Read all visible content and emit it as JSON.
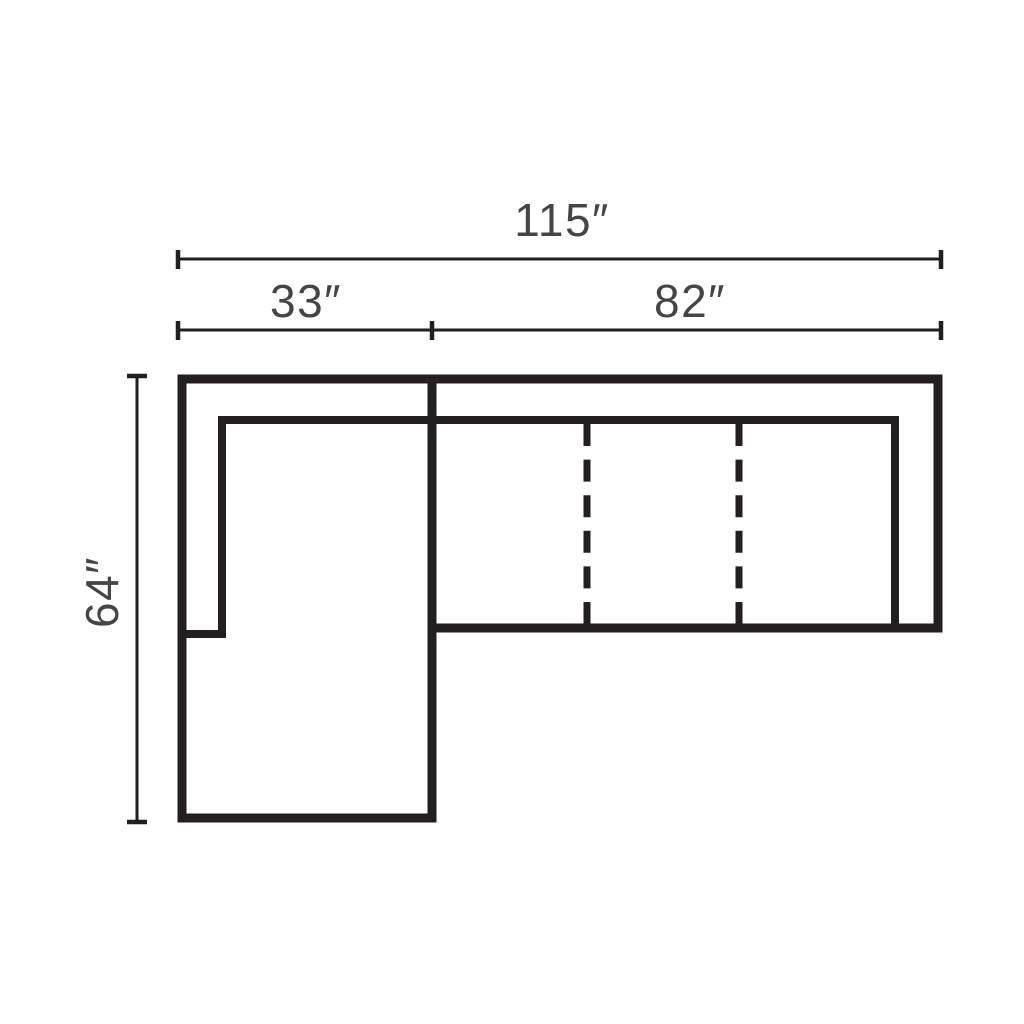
{
  "diagram": {
    "type": "furniture-dimension-plan",
    "subject": "sectional-sofa-with-left-chaise-top-view",
    "dimensions": {
      "total_width": "115″",
      "chaise_width": "33″",
      "sofa_width": "82″",
      "depth": "64″"
    },
    "colors": {
      "line": "#231f20",
      "text": "#454547",
      "background": "#ffffff"
    }
  }
}
